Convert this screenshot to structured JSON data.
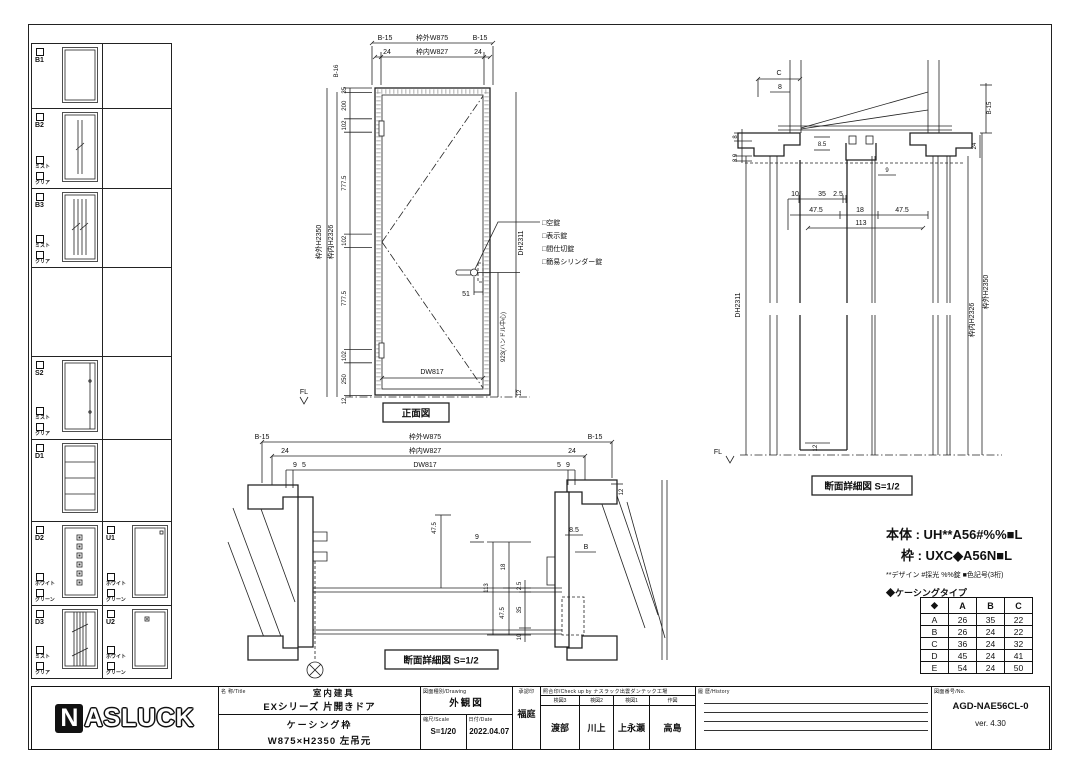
{
  "sidebar": {
    "b1": {
      "code": "B1"
    },
    "b2": {
      "code": "B2",
      "opt1": "ミスト",
      "opt2": "クリア"
    },
    "b3": {
      "code": "B3",
      "opt1": "ミスト",
      "opt2": "クリア"
    },
    "s2": {
      "code": "S2",
      "opt1": "ミスト",
      "opt2": "クリア"
    },
    "d1": {
      "code": "D1"
    },
    "d2": {
      "code": "D2",
      "opt1": "ホワイト",
      "opt2": "グリーン"
    },
    "u1": {
      "code": "U1",
      "opt1": "ホワイト",
      "opt2": "グリーン"
    },
    "d3": {
      "code": "D3",
      "opt1": "ミスト",
      "opt2": "クリア"
    },
    "u2": {
      "code": "U2",
      "opt1": "ホワイト",
      "opt2": "グリーン"
    }
  },
  "front_view": {
    "caption": "正面図",
    "dim_b15_left": "B-15",
    "dim_outer_w": "枠外W875",
    "dim_b15_right": "B-15",
    "dim_24_left": "24",
    "dim_inner_w": "枠内W827",
    "dim_24_right": "24",
    "dim_b16": "B-16",
    "outer_h": "枠外H2350",
    "inner_h": "枠内H2326",
    "chain": [
      "35",
      "200",
      "102",
      "777.5",
      "102",
      "777.5",
      "102",
      "250"
    ],
    "dim_12_bottom": "12",
    "door_w": "DW817",
    "door_h": "DH2311",
    "dim_51": "51",
    "handle_center": "923(ハンドル中心)",
    "dim_12_right": "12",
    "fl": "FL",
    "locks": [
      "□空錠",
      "□表示錠",
      "□間仕切錠",
      "□簡易シリンダー錠"
    ]
  },
  "plan_section": {
    "caption": "断面詳細図 S=1/2",
    "dim_b15_left": "B-15",
    "dim_outer_w": "枠外W875",
    "dim_b15_right": "B-15",
    "dim_24_left": "24",
    "dim_inner_w": "枠内W827",
    "dim_24_right": "24",
    "dim_9_left": "9",
    "dim_5_left": "5",
    "door_w": "DW817",
    "dim_5_right": "5",
    "dim_9_right": "9",
    "v475_top": "47.5",
    "v113": "113",
    "v18": "18",
    "v25": "2.5",
    "v35": "35",
    "v475_bot": "47.5",
    "v10": "10",
    "n9": "9",
    "n85": "8.5",
    "nB": "B",
    "n12": "12"
  },
  "vert_section": {
    "caption": "断面詳細図 S=1/2",
    "nC": "C",
    "n8_top": "8",
    "n8_left": "8",
    "n39": "3.9",
    "b15": "B-15",
    "n24": "24",
    "n85": "8.5",
    "n9": "9",
    "n10": "10",
    "n35": "35",
    "n25": "2.5",
    "n475_l": "47.5",
    "n18": "18",
    "n475_r": "47.5",
    "n113": "113",
    "door_h": "DH2311",
    "inner_h": "枠内H2326",
    "outer_h": "枠外H2350",
    "fl": "FL",
    "n12": "12"
  },
  "spec": {
    "body_label": "本体 : UH**A56#%%■L",
    "frame_label": "枠 : UXC◆A56N■L",
    "note": "**デザイン #採光 %%錠 ■色記号(3桁)",
    "casing_title": "◆ケーシングタイプ"
  },
  "casing_table": {
    "headers": [
      "◆",
      "A",
      "B",
      "C"
    ],
    "rows": [
      [
        "A",
        "26",
        "35",
        "22"
      ],
      [
        "B",
        "26",
        "24",
        "22"
      ],
      [
        "C",
        "36",
        "24",
        "32"
      ],
      [
        "D",
        "45",
        "24",
        "41"
      ],
      [
        "E",
        "54",
        "24",
        "50"
      ]
    ]
  },
  "title_block": {
    "logo_n": "N",
    "logo_rest": "ASLUCK",
    "name_label": "名 称/Title",
    "name1": "室内建具",
    "name2": "EXシリーズ 片開きドア",
    "name3": "ケーシング枠",
    "name4": "W875×H2350 左吊元",
    "drawing_label": "図面種別/Drawing",
    "drawing_type": "外観図",
    "scale_label": "縮尺/Scale",
    "scale": "S=1/20",
    "date_label": "日付/Date",
    "date": "2022.04.07",
    "approval_label": "承認印",
    "approval": "福庭",
    "check_label": "照合印/Check up by ナスラック出雲ダンテック工場",
    "check_cols": [
      {
        "label": "検図3",
        "name": "渡部"
      },
      {
        "label": "検図2",
        "name": "川上"
      },
      {
        "label": "検図1",
        "name": "上永瀬"
      },
      {
        "label": "作図",
        "name": "高島"
      }
    ],
    "history_label": "履 歴/History",
    "no_label": "図面番号/No.",
    "drawing_no": "AGD-NAE56CL-0",
    "version": "ver. 4.30"
  }
}
